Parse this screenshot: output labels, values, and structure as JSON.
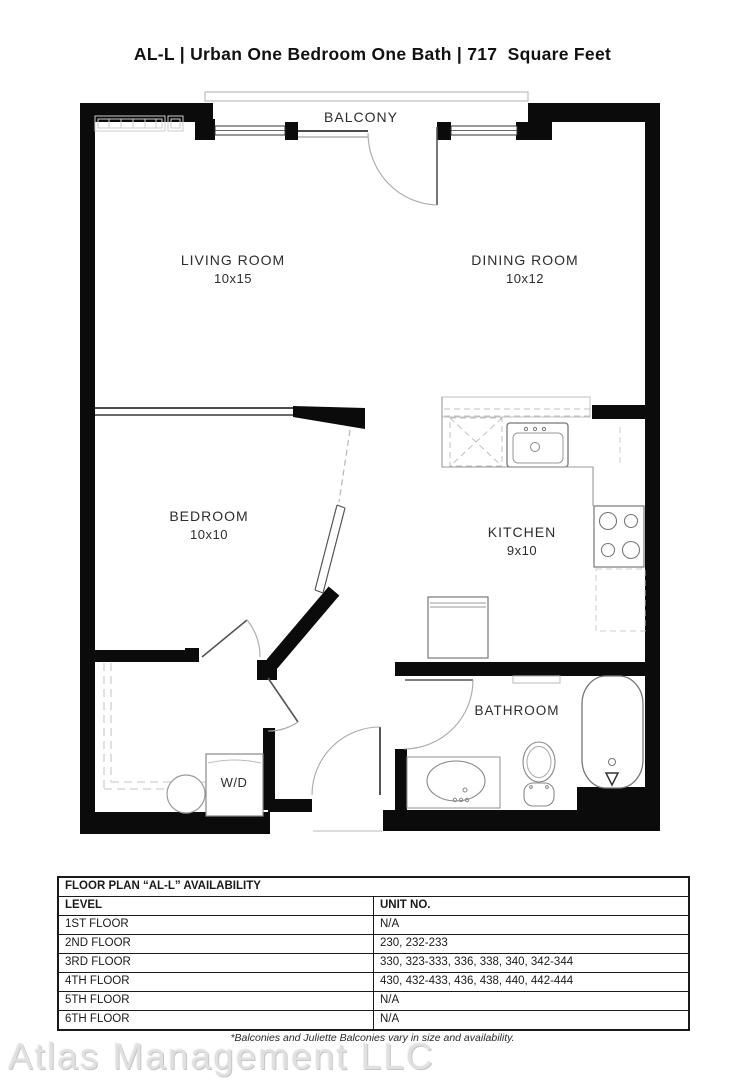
{
  "title": "AL-L | Urban One Bedroom One Bath | 717  Square Feet",
  "floor_plan": {
    "balcony_label": "BALCONY",
    "rooms": [
      {
        "name": "LIVING ROOM",
        "dims": "10x15"
      },
      {
        "name": "DINING ROOM",
        "dims": "10x12"
      },
      {
        "name": "BEDROOM",
        "dims": "10x10"
      },
      {
        "name": "KITCHEN",
        "dims": "9x10"
      },
      {
        "name": "BATHROOM",
        "dims": ""
      }
    ],
    "washer_dryer_label": "W/D"
  },
  "availability_table": {
    "title": "FLOOR PLAN “AL-L” AVAILABILITY",
    "columns": [
      "LEVEL",
      "UNIT NO."
    ],
    "rows": [
      {
        "level": "1ST FLOOR",
        "units": "N/A"
      },
      {
        "level": "2ND FLOOR",
        "units": "230, 232-233"
      },
      {
        "level": "3RD FLOOR",
        "units": "330, 323-333, 336, 338, 340, 342-344"
      },
      {
        "level": "4TH FLOOR",
        "units": "430, 432-433, 436, 438, 440, 442-444"
      },
      {
        "level": "5TH FLOOR",
        "units": "N/A"
      },
      {
        "level": "6TH FLOOR",
        "units": "N/A"
      }
    ]
  },
  "footnote": "*Balconies and Juliette Balconies vary in size and availability.",
  "watermark": "Atlas Management LLC"
}
